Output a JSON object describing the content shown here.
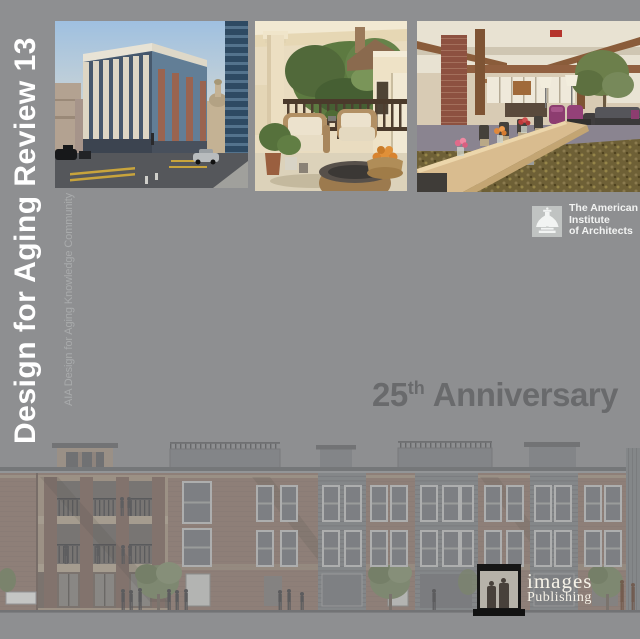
{
  "cover": {
    "vertical_title": "Design for Aging Review 13",
    "vertical_subtitle": "AIA Design for Aging Knowledge Community",
    "anniversary": {
      "number": "25",
      "ordinal": "th",
      "text": "Anniversary"
    },
    "aia_institute": {
      "lines": [
        "The American",
        "Institute",
        "of Architects"
      ]
    },
    "publisher": {
      "name": "images",
      "division": "Publishing"
    }
  },
  "photos": [
    {
      "label": "city corner apartment building at street intersection"
    },
    {
      "label": "porch with wicker seating and greenery"
    },
    {
      "label": "lobby dining interior with long wood table"
    }
  ],
  "colors": {
    "background": "#8e8f91",
    "title_text": "#ffffff",
    "subtitle_text": "#a9abac",
    "anniversary_text": "#696a6c",
    "aia_text": "#f2f3f2",
    "publisher_text": "#f6f2e8"
  }
}
